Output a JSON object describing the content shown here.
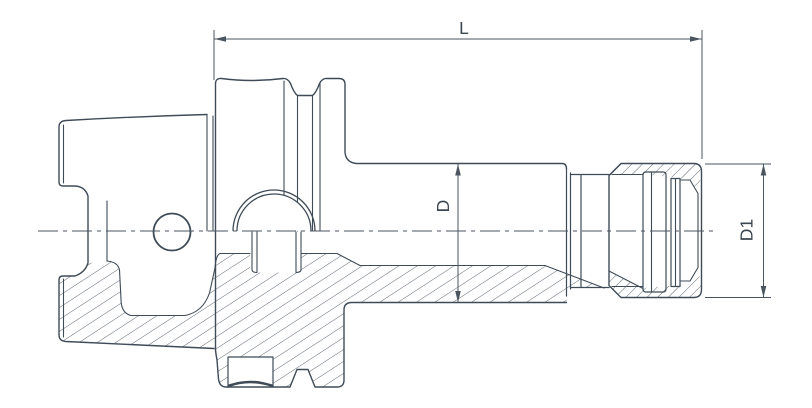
{
  "drawing": {
    "dimension_labels": {
      "length": "L",
      "body_diameter": "D",
      "nut_diameter": "D1"
    },
    "colors": {
      "line": "#3f4b57",
      "hatch": "#4d5865",
      "dimension": "#4a5560",
      "text": "#3d4752",
      "background": "#ffffff"
    }
  }
}
